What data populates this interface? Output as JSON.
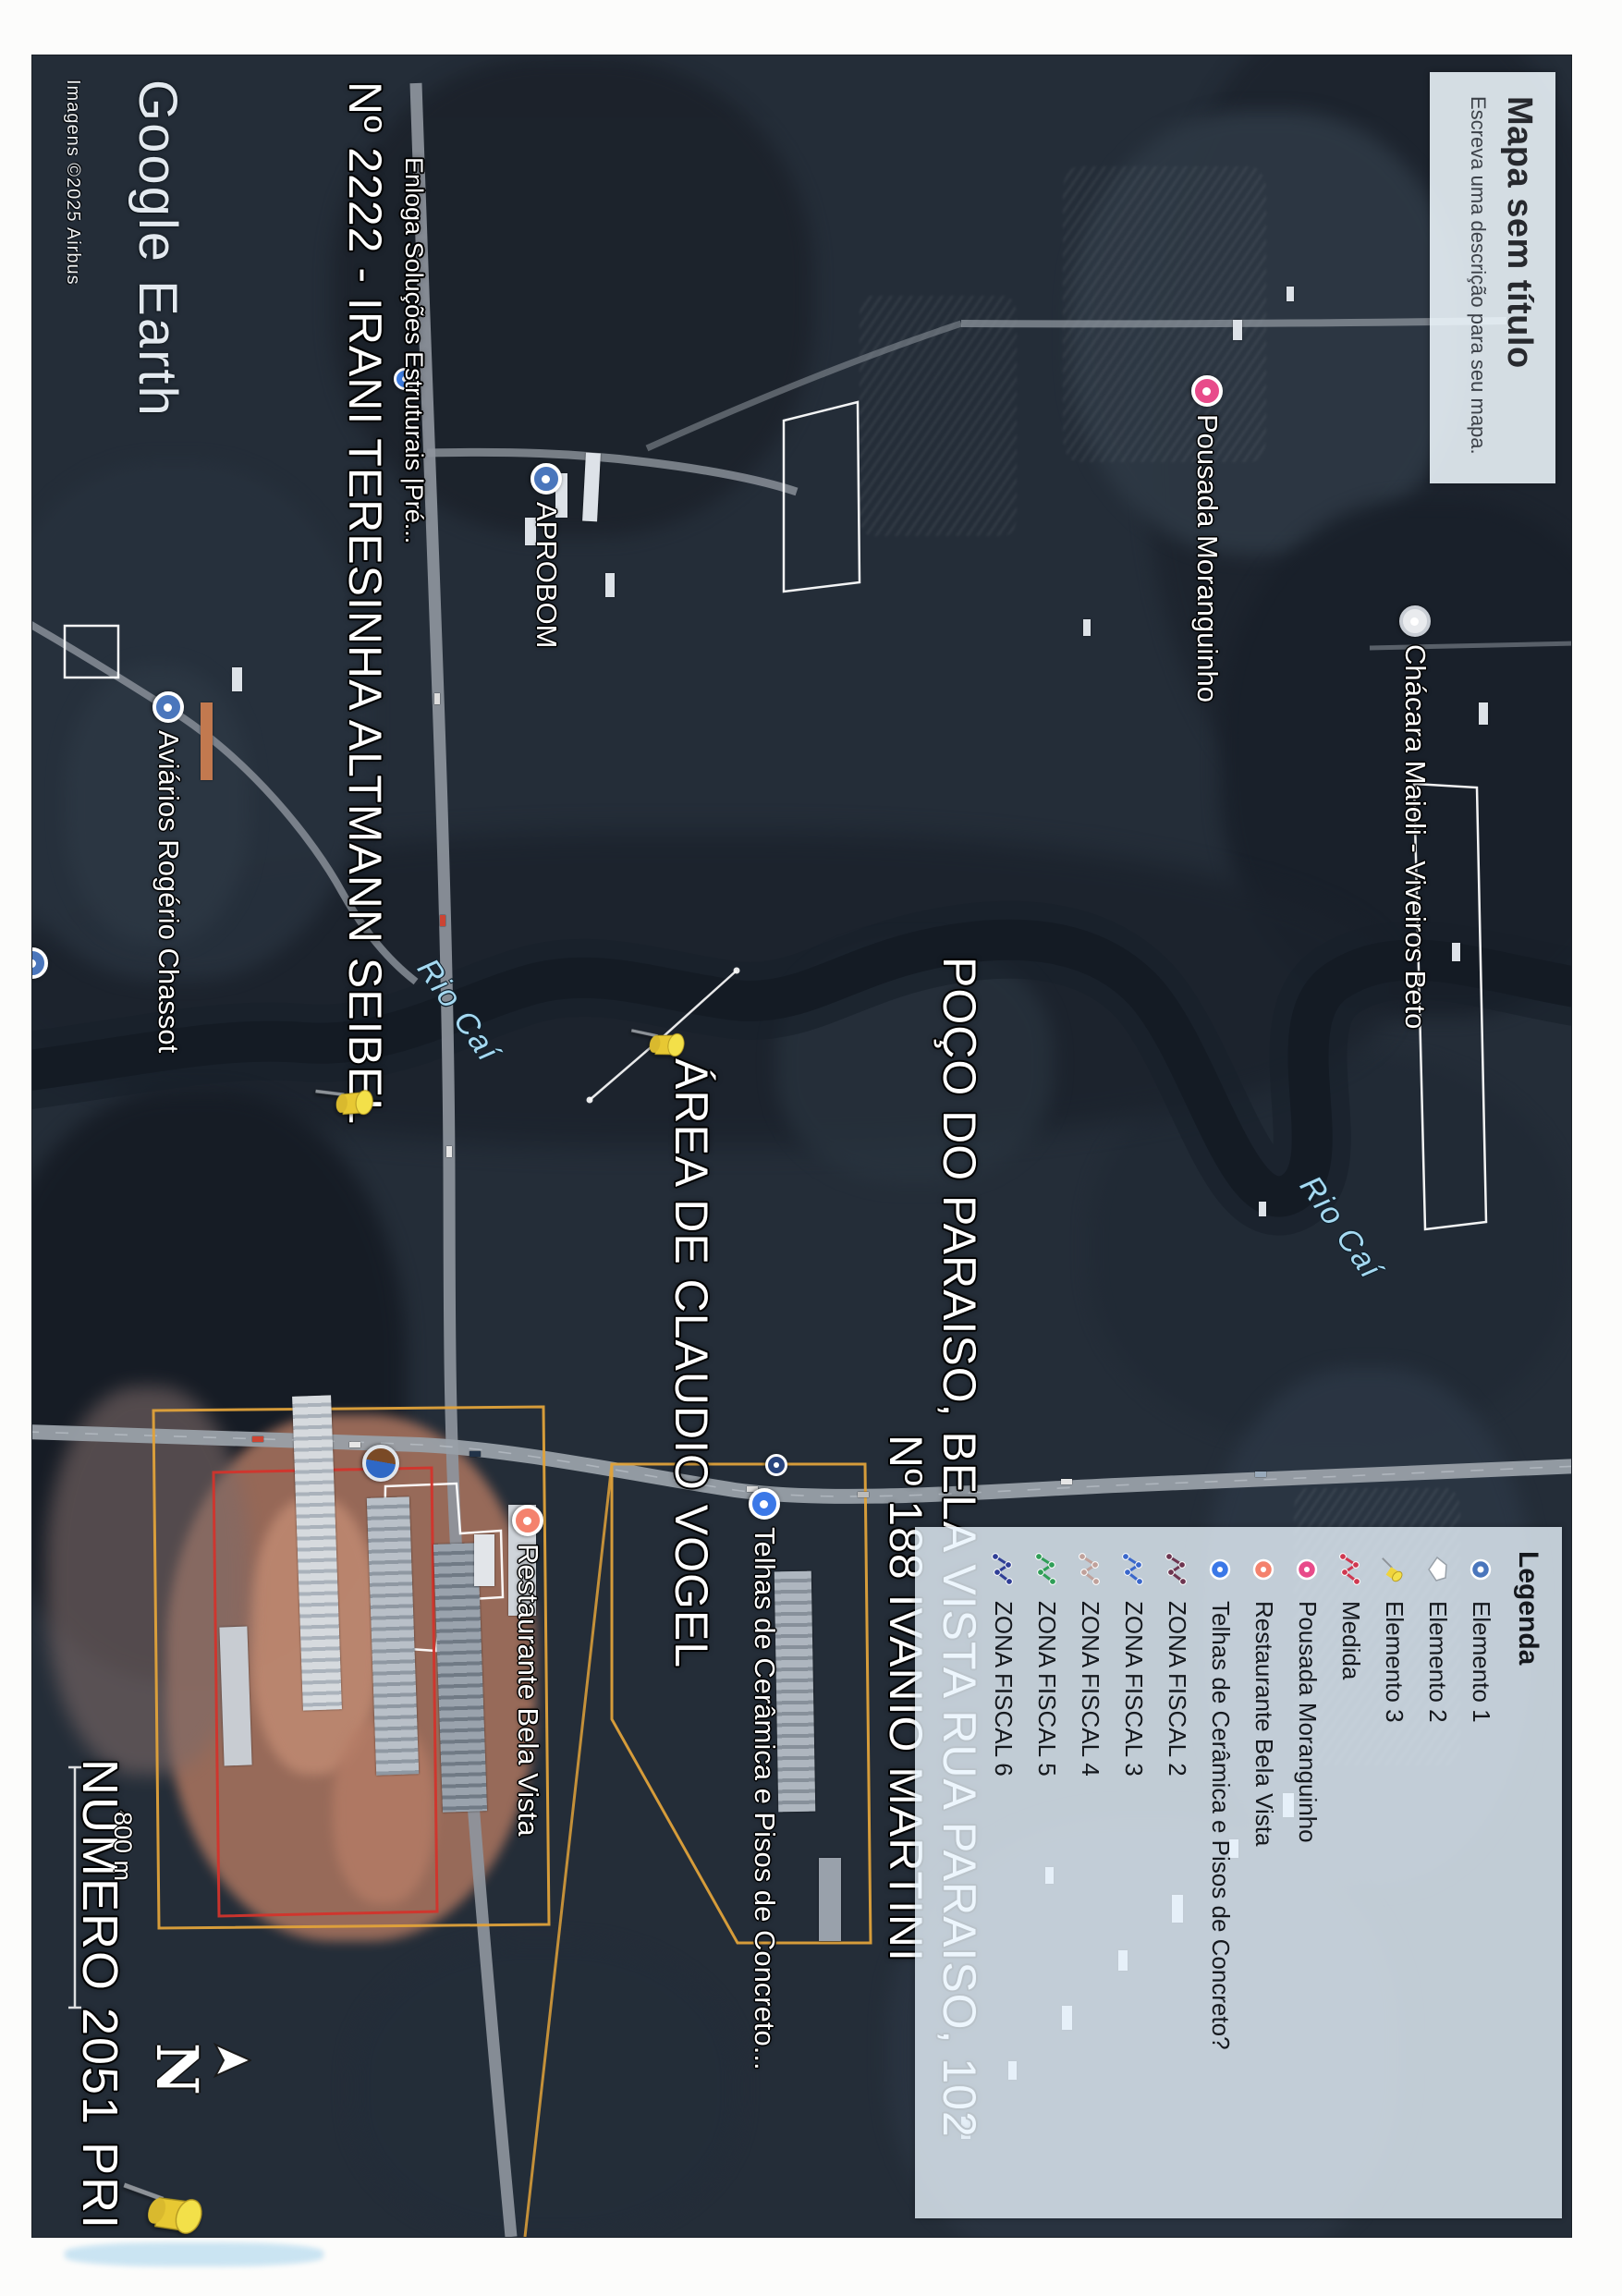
{
  "page": {
    "logo": "Google Earth",
    "attribution": "Imagens ©2025 Airbus"
  },
  "title_box": {
    "title": "Mapa sem título",
    "subtitle": "Escreva uma descrição para seu mapa."
  },
  "legend": {
    "header": "Legenda",
    "items": [
      {
        "label": "Elemento 1",
        "icon": "circle-pin",
        "color": "#4a76bc"
      },
      {
        "label": "Elemento 2",
        "icon": "polygon",
        "color": "#ffffff"
      },
      {
        "label": "Elemento 3",
        "icon": "pushpin",
        "color": "#efd43c"
      },
      {
        "label": "Medida",
        "icon": "polyline",
        "color": "#cf3850"
      },
      {
        "label": "Pousada Moranguinho",
        "icon": "place",
        "color": "#e84b8a"
      },
      {
        "label": "Restaurante Bela Vista",
        "icon": "place",
        "color": "#f4826d"
      },
      {
        "label": "Telhas de Cerâmica e Pisos de Concreto?",
        "icon": "place",
        "color": "#3b78e7"
      },
      {
        "label": "ZONA FISCAL 2",
        "icon": "polyline",
        "color": "#6d3550"
      },
      {
        "label": "ZONA FISCAL 3",
        "icon": "polyline",
        "color": "#3a67cb"
      },
      {
        "label": "ZONA FISCAL 4",
        "icon": "polyline",
        "color": "#c0a19b"
      },
      {
        "label": "ZONA FISCAL 5",
        "icon": "polyline",
        "color": "#2f9e57"
      },
      {
        "label": "ZONA FISCAL 6",
        "icon": "polyline",
        "color": "#2f3e96"
      }
    ]
  },
  "map_labels": {
    "seibel": "Nº 2222 - IRANI TERESINHA ALTMANN SEIBEL",
    "poco": "POÇO DO PARAISO, BELA VISTA RUA PARAISO, 102",
    "ivanio": "Nº 188 IVANIO MARTINI",
    "claudio": "ÁREA DE CLAUDIO VOGEL",
    "numero": "NÚMERO 2051 PRI",
    "rio_cai_1": "Rio Caí",
    "rio_cai_2": "Rio Caí"
  },
  "pois": [
    {
      "label": "Aviários Rogério Chassot",
      "color": "#4a76bc"
    },
    {
      "label": "APROBOM",
      "color": "#4a76bc"
    },
    {
      "label": "Pousada Moranguinho",
      "color": "#e84b8a"
    },
    {
      "label": "Chácara Maioli - Viveiros Beto",
      "color": "#e9ebee"
    },
    {
      "label": "Restaurante Bela Vista",
      "color": "#f4826d"
    },
    {
      "label": "Telhas de Cerâmica e Pisos de Concreto...",
      "color": "#3b78e7"
    },
    {
      "label": "Enloga Soluções Estruturais |Pré...",
      "color": "#3f7de0"
    }
  ],
  "compass": {
    "north": "N"
  },
  "scale": {
    "label": "800 m"
  },
  "map_colors": {
    "pushpin": "#efd43c",
    "zona_boundary": "#e0a23a",
    "elemento_area_red": "#d2342c",
    "measure_line": "#ffffff",
    "river_label_blue": "#a5d9f1"
  }
}
